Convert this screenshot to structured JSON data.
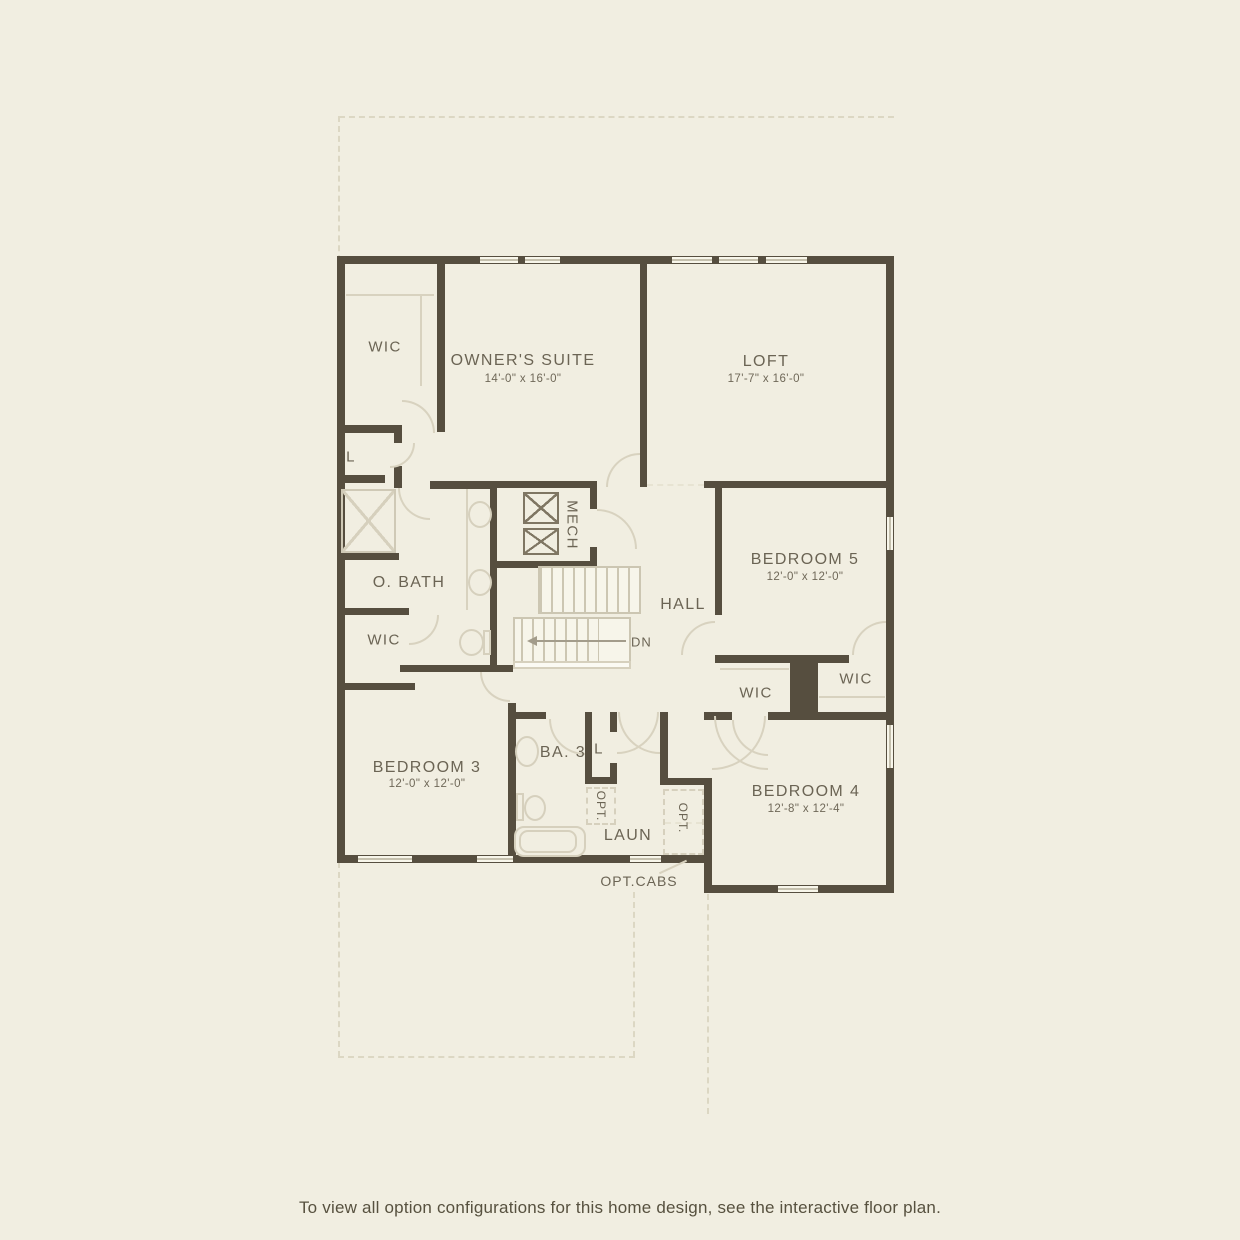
{
  "palette": {
    "background": "#f1eee1",
    "wall": "#564e3f",
    "label_text": "#6b6454",
    "fixture_line": "#d6d0bd",
    "caption_text": "#57513f"
  },
  "rooms": {
    "wic": "WIC",
    "linen": "L",
    "owners_suite": {
      "name": "OWNER'S SUITE",
      "dims": "14'-0\" x 16'-0\""
    },
    "loft": {
      "name": "LOFT",
      "dims": "17'-7\" x 16'-0\""
    },
    "mech": "MECH",
    "owners_bath": "O. BATH",
    "hall": "HALL",
    "bedroom5": {
      "name": "BEDROOM 5",
      "dims": "12'-0\" x 12'-0\""
    },
    "bedroom3": {
      "name": "BEDROOM 3",
      "dims": "12'-0\" x 12'-0\""
    },
    "bath3": "BA. 3",
    "laundry": "LAUN",
    "bedroom4": {
      "name": "BEDROOM 4",
      "dims": "12'-8\" x 12'-4\""
    }
  },
  "markers": {
    "down": "DN",
    "optional": "OPT.",
    "optional_cabinets": "OPT.CABS"
  },
  "caption": "To view all option configurations for this home design, see the interactive floor plan."
}
